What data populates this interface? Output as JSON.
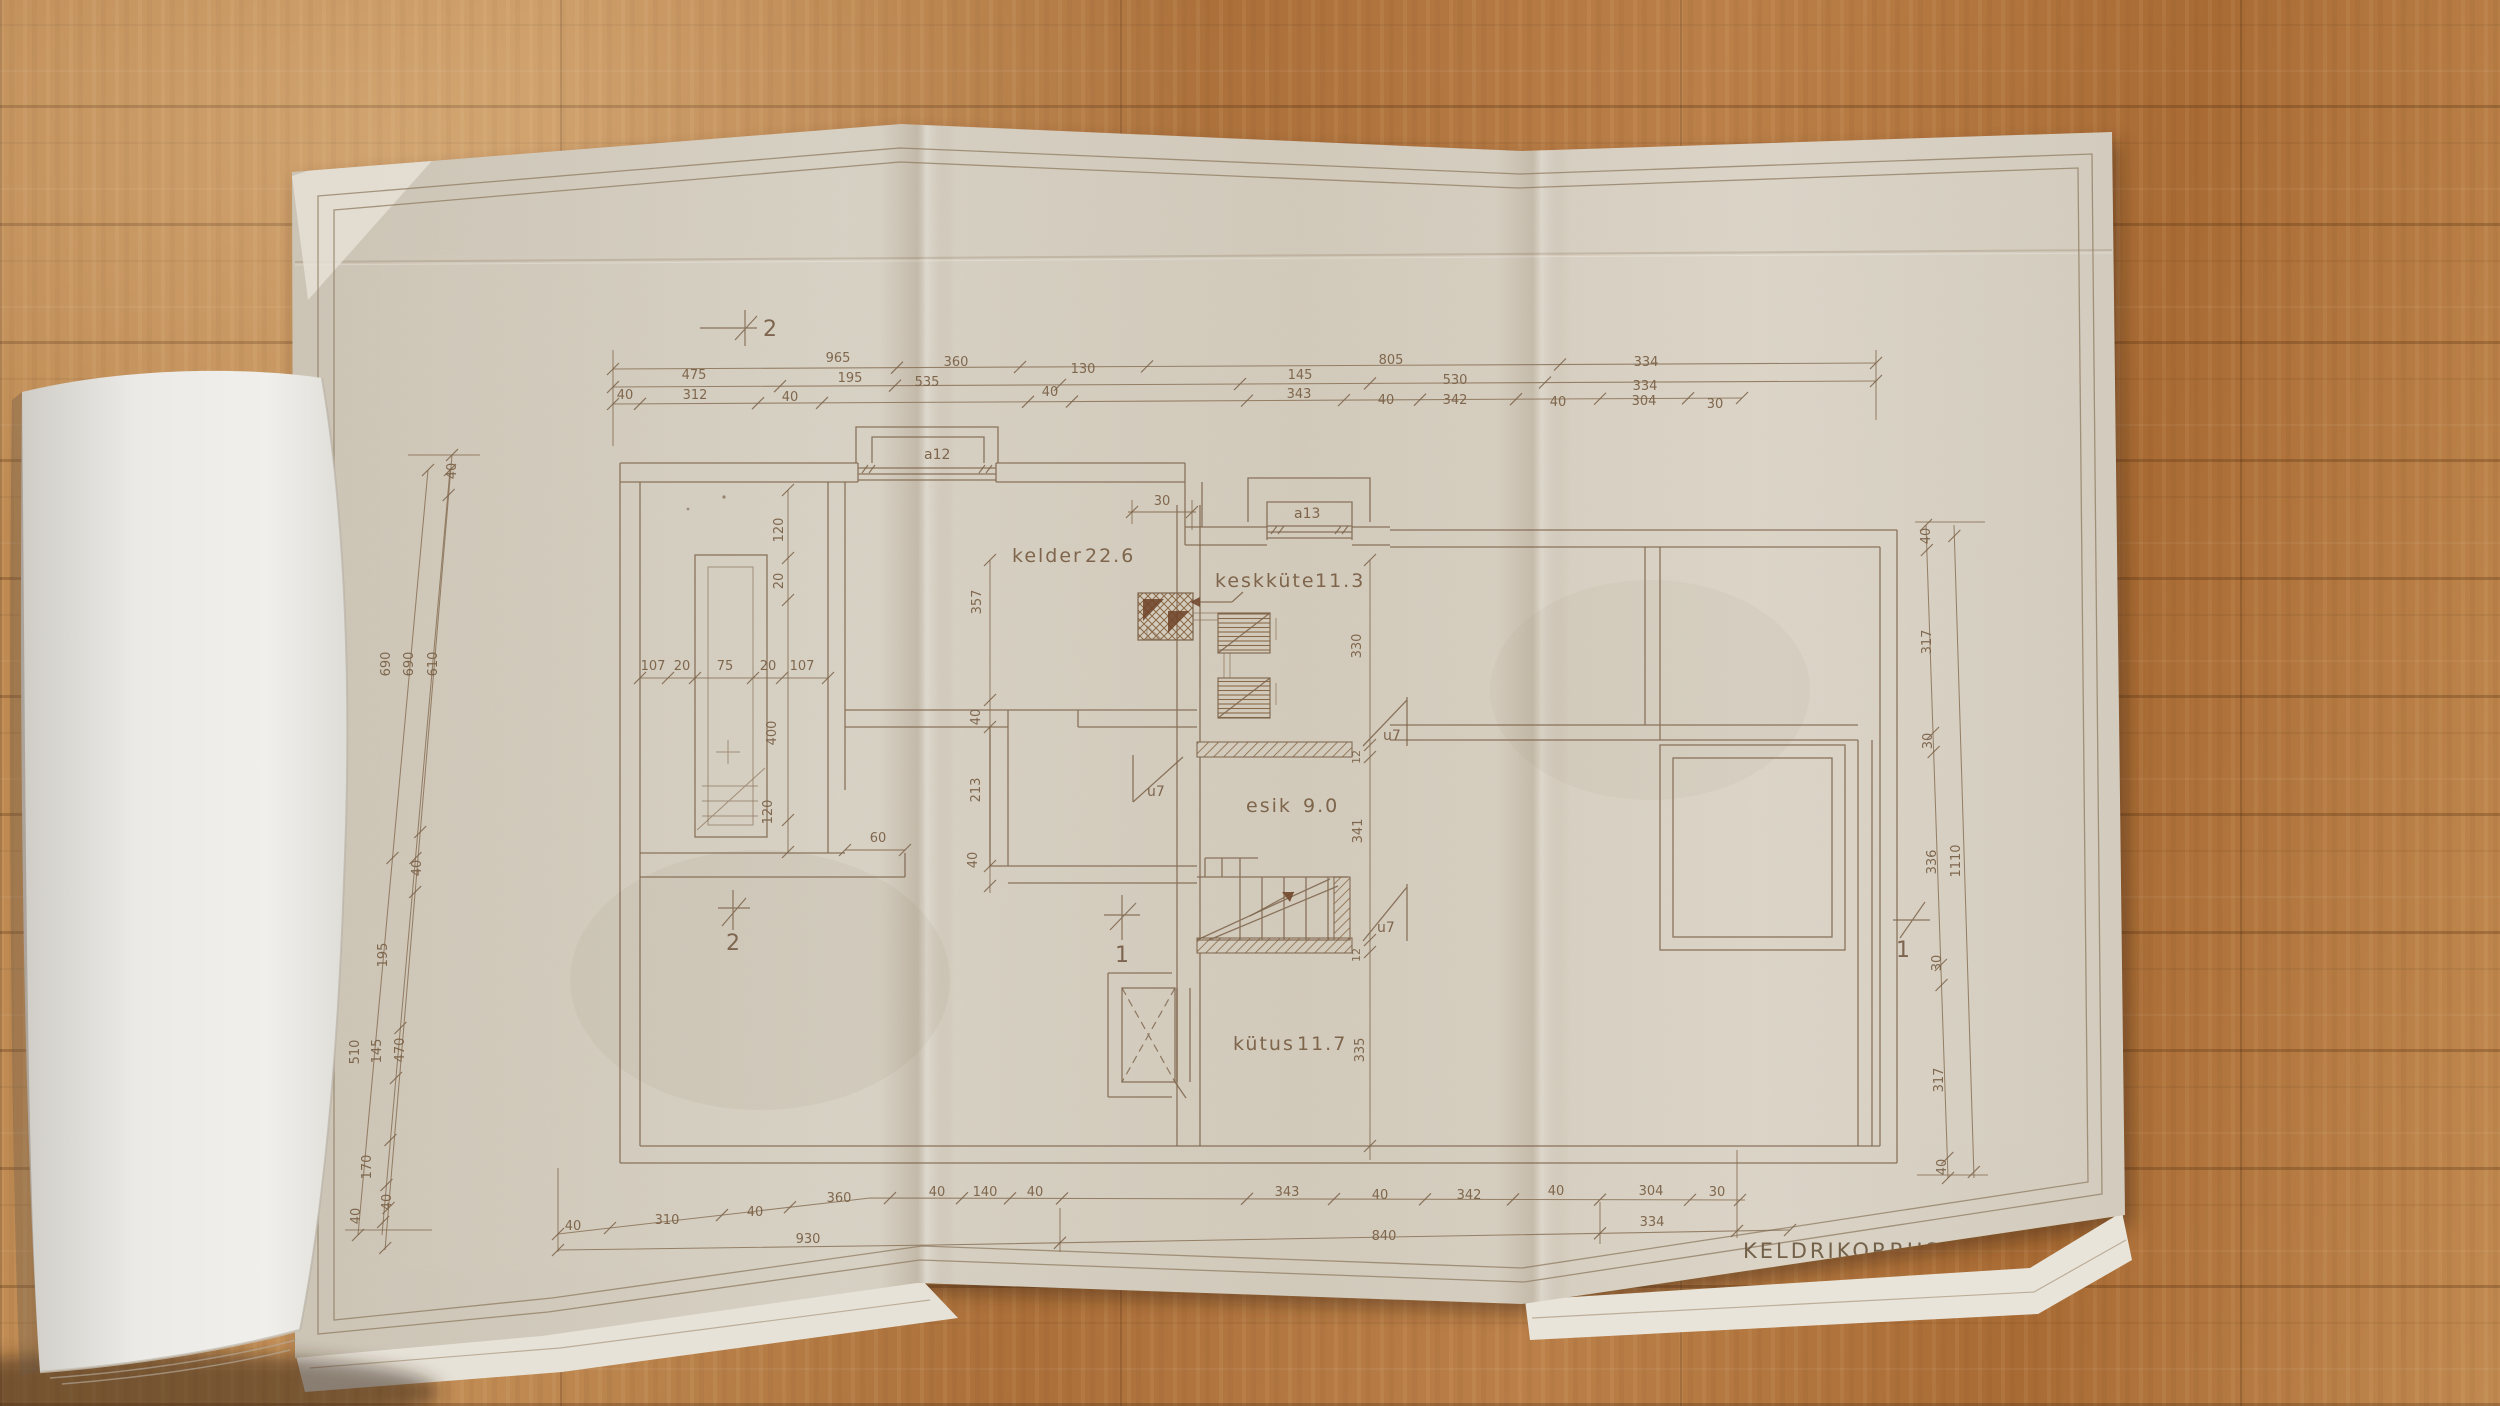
{
  "title_block": {
    "title": "KELDRIKORRUS",
    "scale": "m 1:50"
  },
  "colors": {
    "paper": "#d6cfc2",
    "ink": "#7c634a",
    "wood_floor": "#b67c42",
    "page_white": "#ebeae6"
  },
  "rooms": [
    {
      "name": "kelder",
      "area": "22.6",
      "nx": 1012,
      "ny": 562,
      "ax": 1085
    },
    {
      "name": "keskküte",
      "area": "11.3",
      "nx": 1215,
      "ny": 587,
      "ax": 1315
    },
    {
      "name": "esik",
      "area": "9.0",
      "nx": 1246,
      "ny": 812,
      "ax": 1303
    },
    {
      "name": "kütus",
      "area": "11.7",
      "nx": 1233,
      "ny": 1050,
      "ax": 1297
    }
  ],
  "windows": [
    {
      "id": "a12",
      "x": 924,
      "y": 459
    },
    {
      "id": "a13",
      "x": 1294,
      "y": 518
    }
  ],
  "doors": [
    {
      "id": "u7",
      "x": 1147,
      "y": 796
    },
    {
      "id": "u7",
      "x": 1383,
      "y": 740
    },
    {
      "id": "u7",
      "x": 1377,
      "y": 932
    }
  ],
  "section_markers": [
    {
      "id": "2",
      "x": 770,
      "y": 336
    },
    {
      "id": "2",
      "x": 733,
      "y": 950
    },
    {
      "id": "1",
      "x": 1122,
      "y": 962
    },
    {
      "id": "1",
      "x": 1903,
      "y": 957
    }
  ],
  "dim_labels": [
    {
      "t": "965",
      "x": 838,
      "y": 362
    },
    {
      "t": "360",
      "x": 956,
      "y": 366
    },
    {
      "t": "130",
      "x": 1083,
      "y": 373
    },
    {
      "t": "805",
      "x": 1391,
      "y": 364
    },
    {
      "t": "334",
      "x": 1646,
      "y": 366
    },
    {
      "t": "475",
      "x": 694,
      "y": 379
    },
    {
      "t": "195",
      "x": 850,
      "y": 382
    },
    {
      "t": "535",
      "x": 927,
      "y": 386
    },
    {
      "t": "145",
      "x": 1300,
      "y": 379
    },
    {
      "t": "530",
      "x": 1455,
      "y": 384
    },
    {
      "t": "334",
      "x": 1645,
      "y": 390
    },
    {
      "t": "40",
      "x": 625,
      "y": 399
    },
    {
      "t": "312",
      "x": 695,
      "y": 399
    },
    {
      "t": "40",
      "x": 790,
      "y": 401
    },
    {
      "t": "40",
      "x": 1050,
      "y": 396
    },
    {
      "t": "343",
      "x": 1299,
      "y": 398
    },
    {
      "t": "40",
      "x": 1386,
      "y": 404
    },
    {
      "t": "342",
      "x": 1455,
      "y": 404
    },
    {
      "t": "40",
      "x": 1558,
      "y": 406
    },
    {
      "t": "304",
      "x": 1644,
      "y": 405
    },
    {
      "t": "30",
      "x": 1715,
      "y": 408
    },
    {
      "t": "40",
      "x": 573,
      "y": 1230
    },
    {
      "t": "310",
      "x": 667,
      "y": 1224
    },
    {
      "t": "40",
      "x": 755,
      "y": 1216
    },
    {
      "t": "360",
      "x": 839,
      "y": 1202
    },
    {
      "t": "40",
      "x": 937,
      "y": 1196
    },
    {
      "t": "140",
      "x": 985,
      "y": 1196
    },
    {
      "t": "40",
      "x": 1035,
      "y": 1196
    },
    {
      "t": "343",
      "x": 1287,
      "y": 1196
    },
    {
      "t": "40",
      "x": 1380,
      "y": 1199
    },
    {
      "t": "342",
      "x": 1469,
      "y": 1199
    },
    {
      "t": "40",
      "x": 1556,
      "y": 1195
    },
    {
      "t": "304",
      "x": 1651,
      "y": 1195
    },
    {
      "t": "30",
      "x": 1717,
      "y": 1196
    },
    {
      "t": "930",
      "x": 808,
      "y": 1243
    },
    {
      "t": "840",
      "x": 1384,
      "y": 1240
    },
    {
      "t": "334",
      "x": 1652,
      "y": 1226
    },
    {
      "t": "40",
      "x": 456,
      "y": 471,
      "r": -90
    },
    {
      "t": "690",
      "x": 390,
      "y": 664,
      "r": -90
    },
    {
      "t": "690",
      "x": 413,
      "y": 664,
      "r": -90
    },
    {
      "t": "610",
      "x": 437,
      "y": 664,
      "r": -90
    },
    {
      "t": "40",
      "x": 421,
      "y": 868,
      "r": -90
    },
    {
      "t": "195",
      "x": 387,
      "y": 955,
      "r": -90
    },
    {
      "t": "510",
      "x": 359,
      "y": 1052,
      "r": -90
    },
    {
      "t": "145",
      "x": 381,
      "y": 1051,
      "r": -90
    },
    {
      "t": "470",
      "x": 404,
      "y": 1050,
      "r": -90
    },
    {
      "t": "170",
      "x": 371,
      "y": 1167,
      "r": -90
    },
    {
      "t": "40",
      "x": 391,
      "y": 1202,
      "r": -90
    },
    {
      "t": "40",
      "x": 360,
      "y": 1216,
      "r": -90
    },
    {
      "t": "40",
      "x": 1930,
      "y": 536,
      "r": -90
    },
    {
      "t": "317",
      "x": 1931,
      "y": 642,
      "r": -90
    },
    {
      "t": "30",
      "x": 1932,
      "y": 741,
      "r": -90
    },
    {
      "t": "336",
      "x": 1936,
      "y": 862,
      "r": -90
    },
    {
      "t": "1110",
      "x": 1960,
      "y": 861,
      "r": -90
    },
    {
      "t": "30",
      "x": 1941,
      "y": 963,
      "r": -90
    },
    {
      "t": "317",
      "x": 1943,
      "y": 1080,
      "r": -90
    },
    {
      "t": "40",
      "x": 1946,
      "y": 1167,
      "r": -90
    },
    {
      "t": "357",
      "x": 981,
      "y": 602,
      "r": -90
    },
    {
      "t": "40",
      "x": 980,
      "y": 717,
      "r": -90
    },
    {
      "t": "213",
      "x": 980,
      "y": 790,
      "r": -90
    },
    {
      "t": "40",
      "x": 977,
      "y": 860,
      "r": -90
    },
    {
      "t": "330",
      "x": 1361,
      "y": 646,
      "r": -90
    },
    {
      "t": "12",
      "x": 1360,
      "y": 757,
      "r": -90,
      "s": 11
    },
    {
      "t": "341",
      "x": 1362,
      "y": 831,
      "r": -90
    },
    {
      "t": "12",
      "x": 1360,
      "y": 955,
      "r": -90,
      "s": 11
    },
    {
      "t": "335",
      "x": 1364,
      "y": 1050,
      "r": -90
    },
    {
      "t": "120",
      "x": 783,
      "y": 530,
      "r": -90
    },
    {
      "t": "20",
      "x": 783,
      "y": 581,
      "r": -90
    },
    {
      "t": "400",
      "x": 776,
      "y": 733,
      "r": -90
    },
    {
      "t": "120",
      "x": 772,
      "y": 812,
      "r": -90
    },
    {
      "t": "107",
      "x": 653,
      "y": 670
    },
    {
      "t": "20",
      "x": 682,
      "y": 670
    },
    {
      "t": "75",
      "x": 725,
      "y": 670
    },
    {
      "t": "20",
      "x": 768,
      "y": 670
    },
    {
      "t": "107",
      "x": 802,
      "y": 670
    },
    {
      "t": "30",
      "x": 1162,
      "y": 505
    },
    {
      "t": "60",
      "x": 878,
      "y": 842
    }
  ]
}
